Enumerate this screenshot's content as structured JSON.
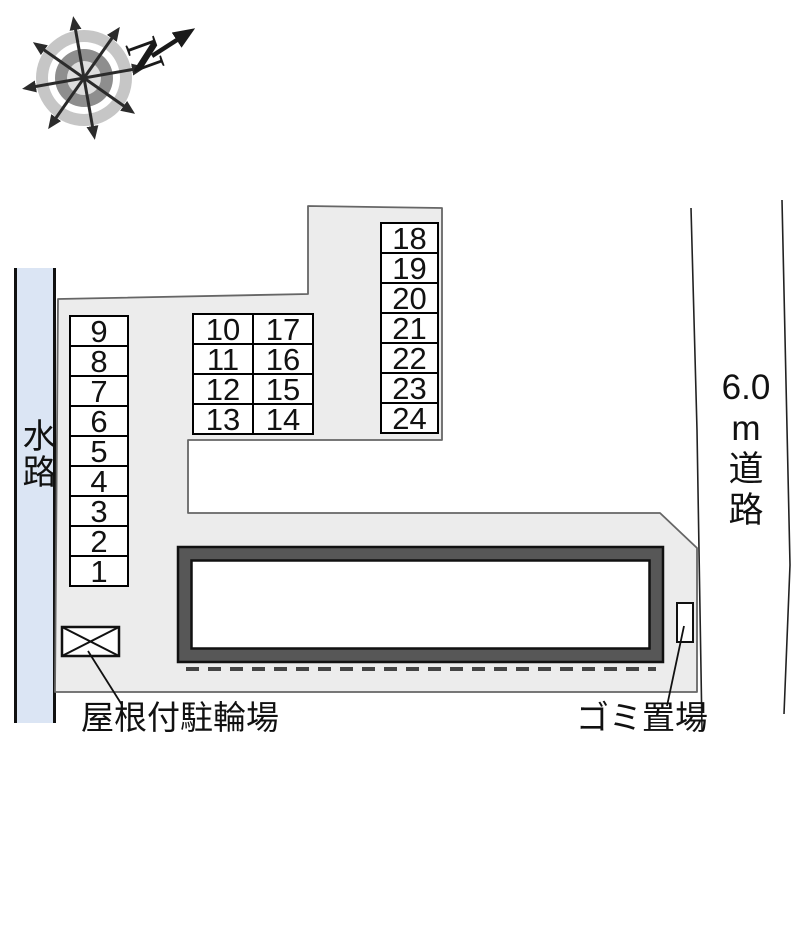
{
  "compass": {
    "north_letter": "N"
  },
  "waterway": {
    "label": "水路"
  },
  "road": {
    "full_label": "6.0 m 道路",
    "lines": [
      "6.0",
      "m",
      "道",
      "路"
    ]
  },
  "parking": {
    "left_column": [
      "9",
      "8",
      "7",
      "6",
      "5",
      "4",
      "3",
      "2",
      "1"
    ],
    "middle_grid_rows": [
      [
        "10",
        "17"
      ],
      [
        "11",
        "16"
      ],
      [
        "12",
        "15"
      ],
      [
        "13",
        "14"
      ]
    ],
    "right_column": [
      "18",
      "19",
      "20",
      "21",
      "22",
      "23",
      "24"
    ]
  },
  "annotations": {
    "bicycle_shed": "屋根付駐輪場",
    "garbage_area": "ゴミ置場"
  },
  "colors": {
    "waterway_blue": "#dbe5f4",
    "lot_gray": "#ececec",
    "building_band": "#575757",
    "compass_ring_light": "#c6c6c6",
    "compass_ring_dark": "#8e8e8e"
  }
}
